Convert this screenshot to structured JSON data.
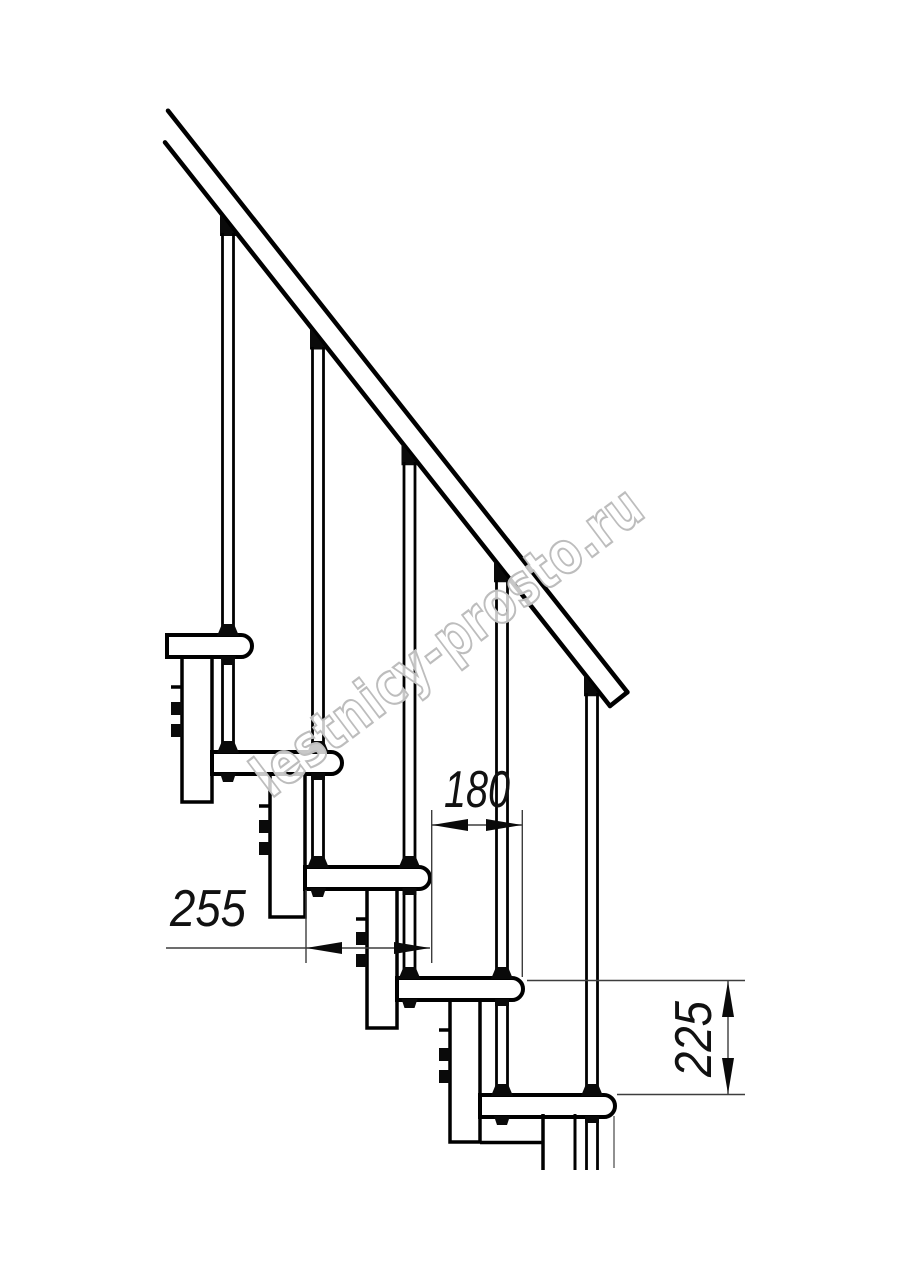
{
  "drawing": {
    "title_hint": "modular staircase side elevation",
    "steps_visible": 5,
    "balusters_visible": 5
  },
  "dimensions": {
    "going": {
      "value": "180"
    },
    "tread_depth": {
      "value": "255"
    },
    "rise": {
      "value": "225"
    }
  },
  "watermark": {
    "text": "lestnicy-prosto.ru",
    "color": "#bdbdbd"
  },
  "colors": {
    "background": "#ffffff",
    "line": "#000000",
    "dimension_line": "#3d3d3d",
    "dimension_text": "#111111"
  }
}
